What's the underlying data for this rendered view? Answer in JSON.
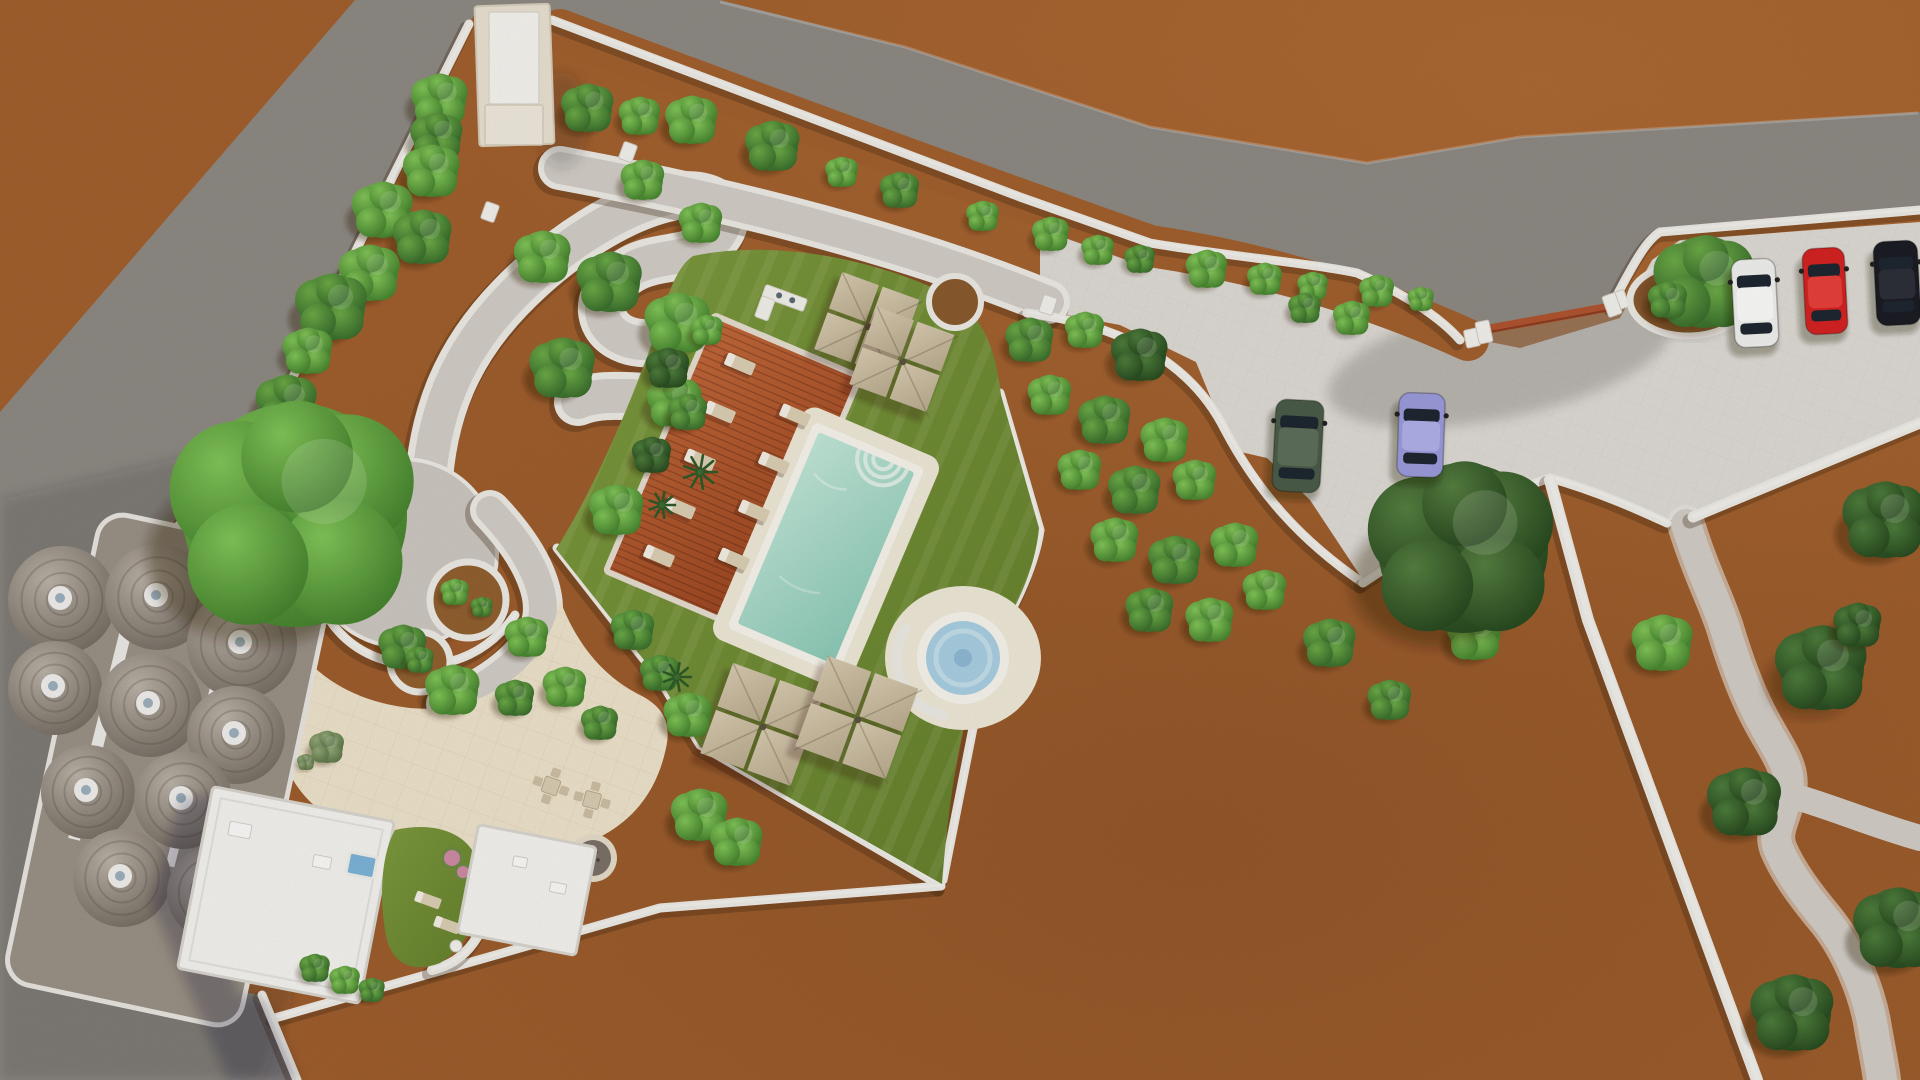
{
  "canvas": {
    "w": 1920,
    "h": 1080
  },
  "palette": {
    "dirt": "#a2602e",
    "dirtDeep": "#7e4a22",
    "dirtLight": "#b97136",
    "road": "#8e8983",
    "roadShade": "rgba(35,35,52,0.16)",
    "parking": "#dedad4",
    "plaza": "#eee3cb",
    "pathGray": "#d2cdc6",
    "circlePlaza": "#ccc7c0",
    "stone": "#edeae4",
    "stoneHi": "#f8f6f2",
    "stoneShadow": "rgba(60,35,15,0.30)",
    "lawnHi": "#7d9a3e",
    "lawnLo": "#647f2c",
    "deckHi": "#c2683a",
    "deckLo": "#98441f",
    "deckLine": "rgba(70,25,10,0.30)",
    "poolPaving": "#efe8d7",
    "poolRim": "#f7f4ec",
    "waterHi": "#c2e7d8",
    "waterLo": "#8cc9b6",
    "steps": "#dff0e6",
    "spaWater": "#a9cfe2",
    "spaRing": "#c3dfea",
    "spaCore": "#8fb9d4",
    "umbHi": "#d8cbb0",
    "umbLo": "#b9ab8e",
    "umbPole": "#5c5142",
    "lounger": "#dbcfb4",
    "loungerPad": "#f4efe4",
    "hutBase": "#9a9186",
    "domeHi": "#bcb3a8",
    "domeLo": "#746b61",
    "domeCap": "#f1efec",
    "domeVent": "#9db0bd",
    "bldgWhite": "#f4f3ef",
    "bldgEdge": "#d9d5cf",
    "bldgCream": "#e9e1d0",
    "bldgRoof": "#f6f4ef",
    "gateRed": "#b05430",
    "gateRedDark": "#8c3c20",
    "miniPool": "#7db4d8",
    "canopyShadow": "rgba(48,27,11,0.34)",
    "pink": "#d98bb0",
    "tree": {
      "bright": [
        "#82c558",
        "#417e2b"
      ],
      "mid": [
        "#6cab47",
        "#35682a"
      ],
      "dark": [
        "#4e7d3c",
        "#26471e"
      ],
      "sage": [
        "#93a877",
        "#5a7346"
      ],
      "bigD": [
        "#567f40",
        "#24451d"
      ]
    }
  },
  "terrain": {
    "road_poly": "355,0 720,0 905,47 1150,127 1367,163 1520,137 1920,112 1920,210 1660,232 1640,250 1612,305 1484,332 1460,340 1440,317 1403,293 1357,273 1310,263 1233,257 1150,243 1020,197 552,20 477,10 469,24 261,441 175,520 115,640 112,800 130,880 200,985 262,995 297,1080 0,1080 0,412",
    "road_shade_poly": "0,500 300,430 262,700 292,1000 262,1080 0,1080",
    "road_edge_hi": "M 720 2 L 905 47 L 1150 127 L 1367 163 L 1520 137 L 1918 113",
    "parking_poly": "1040,212 1150,252 1300,285 1430,330 1520,348 1620,318 1652,260 1680,240 1920,222 1920,418 1700,512 1688,520 1668,520 1550,478 1480,502 1363,580 1310,500 1267,458 1232,450 1196,362 1120,325 1040,310",
    "driveway_blob": {
      "cx": 1500,
      "cy": 360,
      "rx": 175,
      "ry": 58,
      "rot": -12
    },
    "north_strip": {
      "d": "M 560 30 C 800 120 1020 200 1150 246 C 1300 268 1420 318 1468 340",
      "w": 42
    },
    "north_path": {
      "d": "M 560 168 C 760 205 920 250 1048 302",
      "w": 32,
      "wall": 44
    },
    "s_path": {
      "d": "M 428 492 C 432 412 458 352 510 298 C 558 248 622 206 676 196 C 722 190 738 218 712 242 C 690 262 656 254 630 270 C 604 286 596 306 606 324 C 618 344 650 348 672 338 C 698 327 718 332 722 354 C 726 376 706 392 676 396 C 644 400 606 390 578 402",
      "w": 34,
      "wall": 48
    },
    "circle_plaza": {
      "cx": 403,
      "cy": 553,
      "r": 92
    },
    "c_path": {
      "d": "M 490 510 C 534 556 550 598 540 626 C 528 658 492 686 446 704",
      "w": 28,
      "wall": 40
    },
    "winding_path": {
      "d": "M 1686 524 C 1700 570 1716 600 1725 628 C 1738 672 1750 700 1762 722 C 1780 755 1792 768 1788 792 C 1782 820 1772 830 1778 848 C 1788 872 1806 896 1826 920 C 1850 950 1866 990 1872 1022 C 1876 1046 1880 1064 1882 1080",
      "w": 30
    },
    "winding_branch": {
      "d": "M 1786 794 C 1830 806 1870 824 1920 838",
      "w": 26
    },
    "plaza_blob": "M 290 640 C 320 682 360 702 410 708 C 452 712 492 700 525 668 C 545 648 556 622 560 600 C 575 640 600 675 640 695 C 662 706 672 722 666 748 C 658 786 638 818 598 838 C 540 864 458 856 398 844 C 338 832 298 802 284 760 Z",
    "lawn_blob": "M 693 256 C 780 238 880 262 942 292 C 985 312 996 352 1001 395 L 1039 528 C 1035 572 1014 612 989 653 C 966 696 950 780 942 884 L 700 747 L 659 679 L 556 549 C 600 480 640 380 660 320 C 670 288 678 266 693 256 Z"
  },
  "walls": [
    {
      "name": "north-boundary-wall",
      "d": "M 552 20 L 1020 197 L 1150 243 C 1233 257 1310 263 1357 273 C 1403 293 1440 317 1460 340",
      "w": 9
    },
    {
      "name": "gate-east-wall",
      "d": "M 1612 305 C 1640 250 1650 238 1660 232 L 1920 210",
      "w": 9
    },
    {
      "name": "west-boundary-wall",
      "d": "M 469 24 L 261 441 L 177 527",
      "w": 9
    },
    {
      "name": "garden-east-wall",
      "d": "M 1000 393 L 1040 530 C 1034 572 1010 615 988 652 L 943 880",
      "w": 9
    },
    {
      "name": "garden-southwest-wall",
      "d": "M 557 548 L 660 680 L 700 745 L 941 886",
      "w": 9
    },
    {
      "name": "south-boundary-wall",
      "d": "M 275 1018 L 660 908 L 941 886",
      "w": 9
    },
    {
      "name": "southwest-corner-wall",
      "d": "M 262 995 L 297 1080",
      "w": 9
    },
    {
      "name": "orchard-north-wall",
      "d": "M 1027 313 C 1120 325 1190 360 1225 430 C 1258 492 1300 540 1363 583",
      "w": 9
    },
    {
      "name": "parking-south-wall",
      "d": "M 1363 583 L 1480 505 C 1515 490 1538 482 1550 478 C 1600 492 1645 513 1667 523",
      "w": 9
    },
    {
      "name": "long-east-wall",
      "d": "M 1550 480 L 1588 620 L 1757 1080",
      "w": 12
    },
    {
      "name": "parking-southeast-wall",
      "d": "M 1693 517 L 1920 423",
      "w": 11
    },
    {
      "name": "circle-plaza-rim-wall",
      "d": "M 312 570 C 320 630 360 660 410 665 C 455 668 490 650 515 615",
      "w": 9
    },
    {
      "name": "courtyard-crescent-wall",
      "d": "M 398 826 C 452 818 486 846 488 888 C 490 932 466 962 432 970",
      "w": 10
    }
  ],
  "wall_caps": [
    [
      1472,
      338,
      -12
    ],
    [
      1620,
      300,
      -20
    ],
    [
      628,
      152,
      20
    ],
    [
      490,
      212,
      20
    ],
    [
      1048,
      305,
      18
    ]
  ],
  "gate": {
    "posts": [
      [
        1484,
        332,
        -12
      ],
      [
        1612,
        305,
        -20
      ]
    ],
    "beam": {
      "x1": 1489,
      "y1": 329,
      "x2": 1610,
      "y2": 307,
      "w": 9
    }
  },
  "planters": {
    "gate": {
      "cx": 1688,
      "cy": 300,
      "rx": 58,
      "ry": 36
    },
    "plaza": [
      {
        "cx": 468,
        "cy": 600,
        "r": 38
      },
      {
        "cx": 420,
        "cy": 662,
        "r": 30
      }
    ],
    "lawn_ne": {
      "cx": 955,
      "cy": 302,
      "r": 26
    }
  },
  "pool": {
    "cx": 826,
    "cy": 548,
    "w": 104,
    "h": 208,
    "rot": 23,
    "pavingPad": 22,
    "rimPad": 8,
    "steps": {
      "lx": 18,
      "r": [
        10,
        18,
        26
      ]
    }
  },
  "spa": {
    "cx": 963,
    "cy": 658,
    "paving_rx": 78,
    "paving_ry": 72,
    "rOuter": 46,
    "rWater": 37,
    "rRing": 27,
    "rCore": 9,
    "benchR": 57
  },
  "deck": {
    "cx": 733,
    "cy": 474,
    "w": 152,
    "h": 272,
    "rot": 23,
    "plankStep": 7
  },
  "loungers": [
    [
      740,
      364,
      23
    ],
    [
      720,
      412,
      23
    ],
    [
      700,
      460,
      23
    ],
    [
      680,
      508,
      23
    ],
    [
      659,
      556,
      23
    ],
    [
      795,
      415,
      23
    ],
    [
      774,
      463,
      23
    ],
    [
      754,
      511,
      23
    ],
    [
      734,
      559,
      23
    ]
  ],
  "courtyard_loungers": [
    [
      428,
      900,
      20
    ],
    [
      447,
      925,
      20
    ]
  ],
  "umbrellas": [
    [
      868,
      327,
      86,
      20
    ],
    [
      903,
      362,
      86,
      20
    ],
    [
      763,
      727,
      100,
      20
    ],
    [
      858,
      720,
      100,
      20
    ]
  ],
  "bar": {
    "x": 782,
    "y": 305,
    "rot": 20
  },
  "firepit": {
    "cx": 593,
    "cy": 858,
    "rOuter": 24,
    "rGravel": 18
  },
  "dining_sets": [
    [
      551,
      786,
      20
    ],
    [
      592,
      800,
      15
    ]
  ],
  "benches": [
    [
      290,
      741,
      18,
      7,
      10
    ]
  ],
  "buildings": {
    "top": {
      "base": [
        477,
        5,
        75,
        140,
        -2
      ],
      "roof": [
        489,
        12,
        50,
        92
      ],
      "annex": [
        485,
        105,
        58,
        40
      ]
    },
    "a": {
      "cx": 286,
      "cy": 895,
      "w": 185,
      "h": 185,
      "rot": 11
    },
    "b": {
      "cx": 527,
      "cy": 890,
      "w": 120,
      "h": 110,
      "rot": 11
    },
    "mini_pool": {
      "x": 350,
      "y": 852,
      "w": 28,
      "h": 22,
      "rot": 11
    },
    "roof_boxes": [
      [
        240,
        830,
        22,
        14,
        11
      ],
      [
        322,
        862,
        18,
        12,
        11
      ],
      [
        520,
        862,
        14,
        10,
        11
      ],
      [
        558,
        888,
        16,
        10,
        11
      ]
    ]
  },
  "courtyard": {
    "lawn": "M 395 830 C 440 820 472 836 479 866 C 486 902 470 946 440 963 C 414 973 394 965 387 940 C 379 905 380 856 395 830 Z",
    "pink": [
      [
        452,
        858,
        8
      ],
      [
        463,
        872,
        6
      ]
    ],
    "table": [
      456,
      946,
      6
    ]
  },
  "huts": {
    "plinth": {
      "cx": 170,
      "cy": 770,
      "w": 240,
      "h": 480,
      "rot": 12
    },
    "domes": [
      [
        62,
        600,
        54
      ],
      [
        158,
        597,
        53
      ],
      [
        242,
        644,
        55
      ],
      [
        55,
        688,
        47
      ],
      [
        150,
        705,
        52
      ],
      [
        236,
        735,
        49
      ],
      [
        88,
        792,
        47
      ],
      [
        183,
        800,
        49
      ],
      [
        122,
        878,
        49
      ],
      [
        214,
        893,
        47
      ]
    ],
    "strips": [
      [
        100,
        735,
        12,
        215,
        14
      ],
      [
        196,
        762,
        9,
        215,
        14
      ]
    ]
  },
  "cars": [
    {
      "name": "car-dark-green",
      "x": 1298,
      "y": 446,
      "rot": 3,
      "wid": 48,
      "len": 92,
      "body": "#4b5c49",
      "roof": "#5d6f5a"
    },
    {
      "name": "car-lavender",
      "x": 1421,
      "y": 435,
      "rot": 2,
      "wid": 46,
      "len": 84,
      "body": "#9b9bdc",
      "roof": "#b0b0ea"
    },
    {
      "name": "car-white",
      "x": 1755,
      "y": 303,
      "rot": -3,
      "wid": 44,
      "len": 88,
      "body": "#f0f0ee",
      "roof": "#fbfbfa"
    },
    {
      "name": "car-red",
      "x": 1825,
      "y": 291,
      "rot": -3,
      "wid": 42,
      "len": 86,
      "body": "#d42322",
      "roof": "#e8403a"
    },
    {
      "name": "car-black",
      "x": 1897,
      "y": 283,
      "rot": -3,
      "wid": 44,
      "len": 84,
      "body": "#1c1d24",
      "roof": "#2e3039"
    }
  ],
  "trees": [
    [
      588,
      108,
      24,
      "mid"
    ],
    [
      640,
      116,
      19,
      "bright"
    ],
    [
      692,
      120,
      24,
      "bright"
    ],
    [
      773,
      146,
      25,
      "mid"
    ],
    [
      842,
      172,
      15,
      "bright"
    ],
    [
      900,
      190,
      18,
      "mid"
    ],
    [
      983,
      216,
      15,
      "bright"
    ],
    [
      1051,
      234,
      17,
      "bright"
    ],
    [
      1098,
      250,
      15,
      "bright"
    ],
    [
      1140,
      259,
      14,
      "mid"
    ],
    [
      1207,
      269,
      19,
      "bright"
    ],
    [
      1265,
      279,
      16,
      "bright"
    ],
    [
      1313,
      286,
      14,
      "bright"
    ],
    [
      1377,
      291,
      16,
      "bright"
    ],
    [
      1421,
      299,
      12,
      "bright"
    ],
    [
      440,
      100,
      26,
      "bright"
    ],
    [
      437,
      137,
      24,
      "mid"
    ],
    [
      432,
      171,
      26,
      "bright"
    ],
    [
      383,
      210,
      28,
      "bright"
    ],
    [
      423,
      237,
      27,
      "mid"
    ],
    [
      370,
      273,
      28,
      "bright"
    ],
    [
      332,
      307,
      33,
      "mid"
    ],
    [
      308,
      351,
      23,
      "bright"
    ],
    [
      287,
      403,
      28,
      "mid"
    ],
    [
      295,
      515,
      112,
      "bright"
    ],
    [
      543,
      257,
      26,
      "bright"
    ],
    [
      610,
      282,
      30,
      "mid"
    ],
    [
      678,
      323,
      30,
      "bright"
    ],
    [
      701,
      223,
      20,
      "bright"
    ],
    [
      643,
      180,
      20,
      "bright"
    ],
    [
      563,
      368,
      30,
      "mid"
    ],
    [
      675,
      402,
      25,
      "bright"
    ],
    [
      707,
      330,
      15,
      "bright"
    ],
    [
      527,
      637,
      20,
      "bright"
    ],
    [
      453,
      690,
      25,
      "bright"
    ],
    [
      515,
      698,
      18,
      "mid"
    ],
    [
      565,
      687,
      20,
      "bright"
    ],
    [
      600,
      723,
      17,
      "mid"
    ],
    [
      403,
      647,
      22,
      "mid"
    ],
    [
      617,
      510,
      25,
      "bright"
    ],
    [
      633,
      630,
      20,
      "mid"
    ],
    [
      660,
      673,
      18,
      "mid"
    ],
    [
      688,
      715,
      22,
      "bright"
    ],
    [
      668,
      368,
      20,
      "dark"
    ],
    [
      688,
      412,
      18,
      "mid"
    ],
    [
      652,
      455,
      18,
      "dark"
    ],
    [
      700,
      815,
      26,
      "bright"
    ],
    [
      737,
      842,
      24,
      "bright"
    ],
    [
      315,
      968,
      14,
      "mid"
    ],
    [
      345,
      980,
      14,
      "bright"
    ],
    [
      372,
      990,
      12,
      "mid"
    ],
    [
      327,
      747,
      16,
      "sage"
    ],
    [
      306,
      762,
      8,
      "sage"
    ],
    [
      455,
      592,
      13,
      "bright"
    ],
    [
      482,
      607,
      10,
      "mid"
    ],
    [
      420,
      660,
      13,
      "mid"
    ],
    [
      1030,
      340,
      22,
      "mid"
    ],
    [
      1085,
      330,
      18,
      "bright"
    ],
    [
      1140,
      355,
      26,
      "dark"
    ],
    [
      1050,
      395,
      20,
      "bright"
    ],
    [
      1105,
      420,
      24,
      "mid"
    ],
    [
      1165,
      440,
      22,
      "bright"
    ],
    [
      1080,
      470,
      20,
      "bright"
    ],
    [
      1135,
      490,
      24,
      "mid"
    ],
    [
      1195,
      480,
      20,
      "bright"
    ],
    [
      1115,
      540,
      22,
      "bright"
    ],
    [
      1175,
      560,
      24,
      "mid"
    ],
    [
      1235,
      545,
      22,
      "bright"
    ],
    [
      1150,
      610,
      22,
      "mid"
    ],
    [
      1210,
      620,
      22,
      "bright"
    ],
    [
      1265,
      590,
      20,
      "bright"
    ],
    [
      1330,
      643,
      24,
      "mid"
    ],
    [
      1475,
      635,
      25,
      "bright"
    ],
    [
      1390,
      700,
      20,
      "mid"
    ],
    [
      1463,
      548,
      85,
      "bigD"
    ],
    [
      1705,
      282,
      46,
      "mid"
    ],
    [
      1668,
      300,
      18,
      "mid"
    ],
    [
      1305,
      308,
      15,
      "mid"
    ],
    [
      1352,
      318,
      17,
      "bright"
    ],
    [
      1663,
      643,
      28,
      "bright"
    ],
    [
      1822,
      668,
      42,
      "dark"
    ],
    [
      1745,
      802,
      34,
      "dark"
    ],
    [
      1898,
      928,
      40,
      "dark"
    ],
    [
      1793,
      1013,
      38,
      "dark"
    ],
    [
      1885,
      520,
      38,
      "dark"
    ],
    [
      1858,
      625,
      22,
      "dark"
    ]
  ],
  "spiky_plants": [
    [
      700,
      472,
      17
    ],
    [
      662,
      505,
      13
    ],
    [
      677,
      677,
      14
    ]
  ]
}
